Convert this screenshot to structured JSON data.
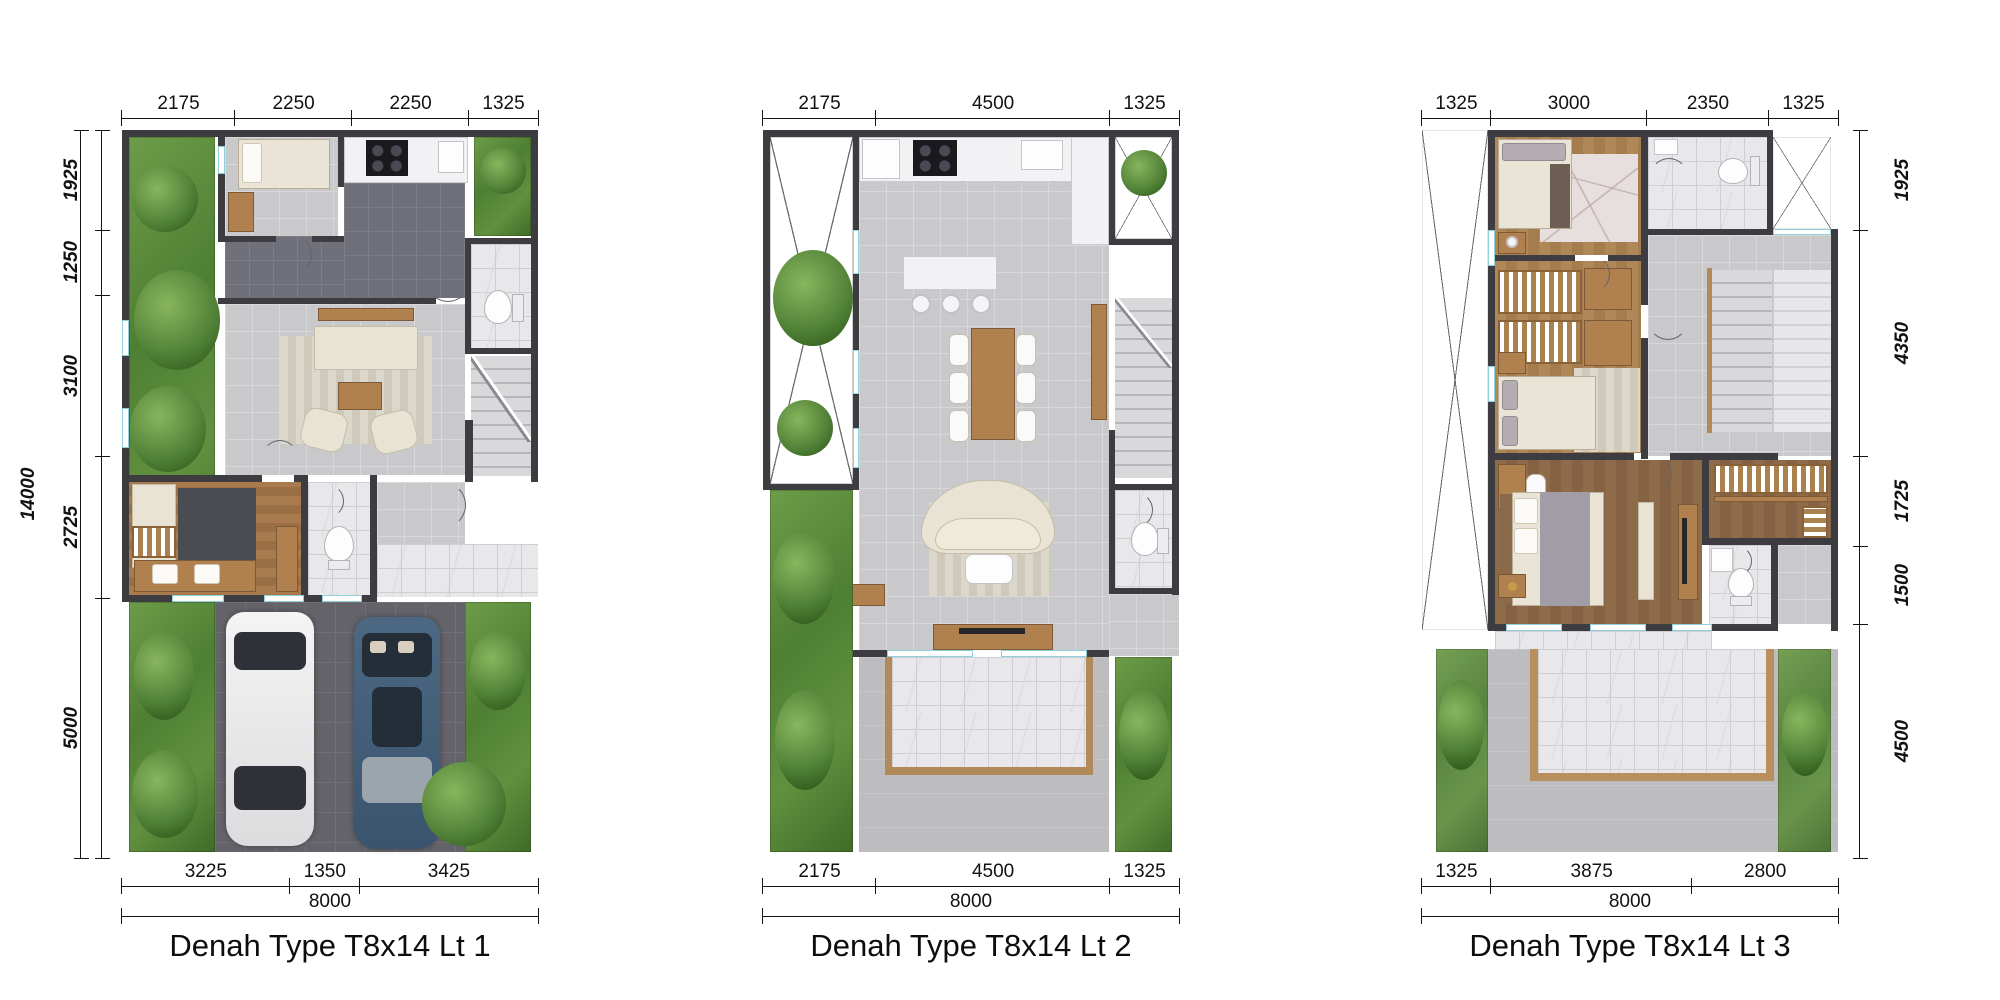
{
  "plans": [
    {
      "title": "Denah Type T8x14 Lt 1",
      "top_dims": [
        "2175",
        "2250",
        "2250",
        "1325"
      ],
      "left_overall": "14000",
      "left_dims": [
        "1925",
        "1250",
        "3100",
        "2725",
        "5000"
      ],
      "bottom_dims": [
        "3225",
        "1350",
        "3425"
      ],
      "bottom_overall": "8000"
    },
    {
      "title": "Denah Type T8x14 Lt 2",
      "top_dims": [
        "2175",
        "4500",
        "1325"
      ],
      "bottom_dims": [
        "2175",
        "4500",
        "1325"
      ],
      "bottom_overall": "8000"
    },
    {
      "title": "Denah Type T8x14 Lt 3",
      "top_dims": [
        "1325",
        "3000",
        "2350",
        "1325"
      ],
      "right_dims": [
        "1925",
        "4350",
        "1725",
        "1500",
        "4500"
      ],
      "bottom_dims": [
        "1325",
        "3875",
        "2800"
      ],
      "bottom_overall": "8000"
    }
  ],
  "palette": {
    "wall": "#3d3d41",
    "floor_light": "#c9c9cb",
    "floor_dark": "#70707a",
    "carport": "#636369",
    "marble": "#e8e8ea",
    "wood": "#b0814f",
    "garden_green": "#4f7f33",
    "garden_faded": "#bccbae",
    "window_accent": "#8fd0dc",
    "car_white": "#ededed",
    "car_blue": "#47617b",
    "dim_text": "#111111"
  }
}
